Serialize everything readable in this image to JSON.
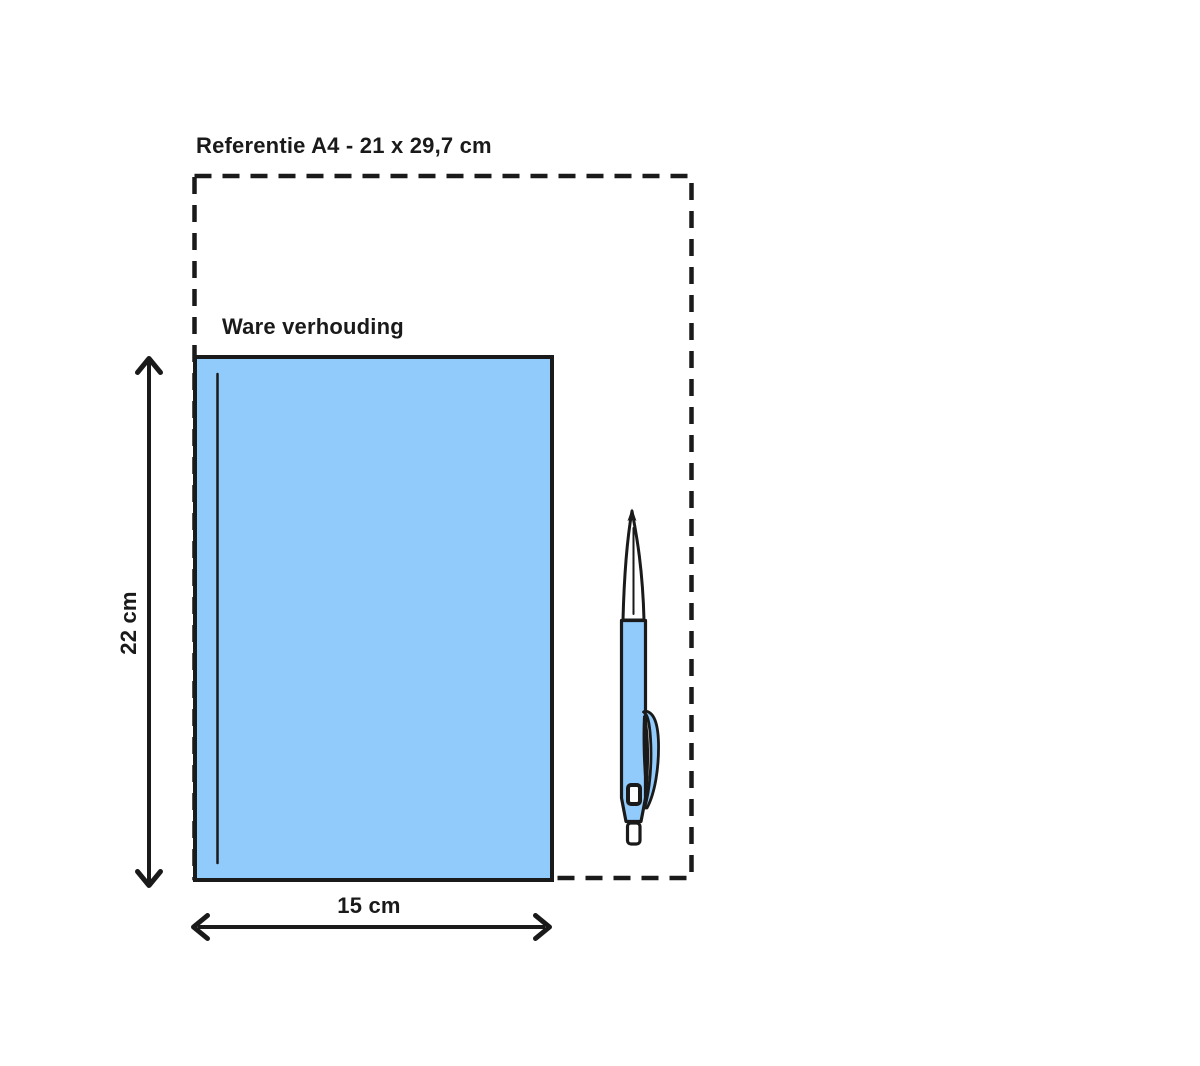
{
  "diagram": {
    "reference": {
      "label": "Referentie A4 - 21 x 29,7 cm"
    },
    "product": {
      "scale_label": "Ware verhouding",
      "height_label": "22 cm",
      "width_label": "15 cm"
    },
    "icons": {
      "pen_icon": "ballpoint-pen"
    }
  },
  "colors": {
    "line": "#1a1a1a",
    "fill_blue": "#90cbfc",
    "background": "#ffffff"
  }
}
